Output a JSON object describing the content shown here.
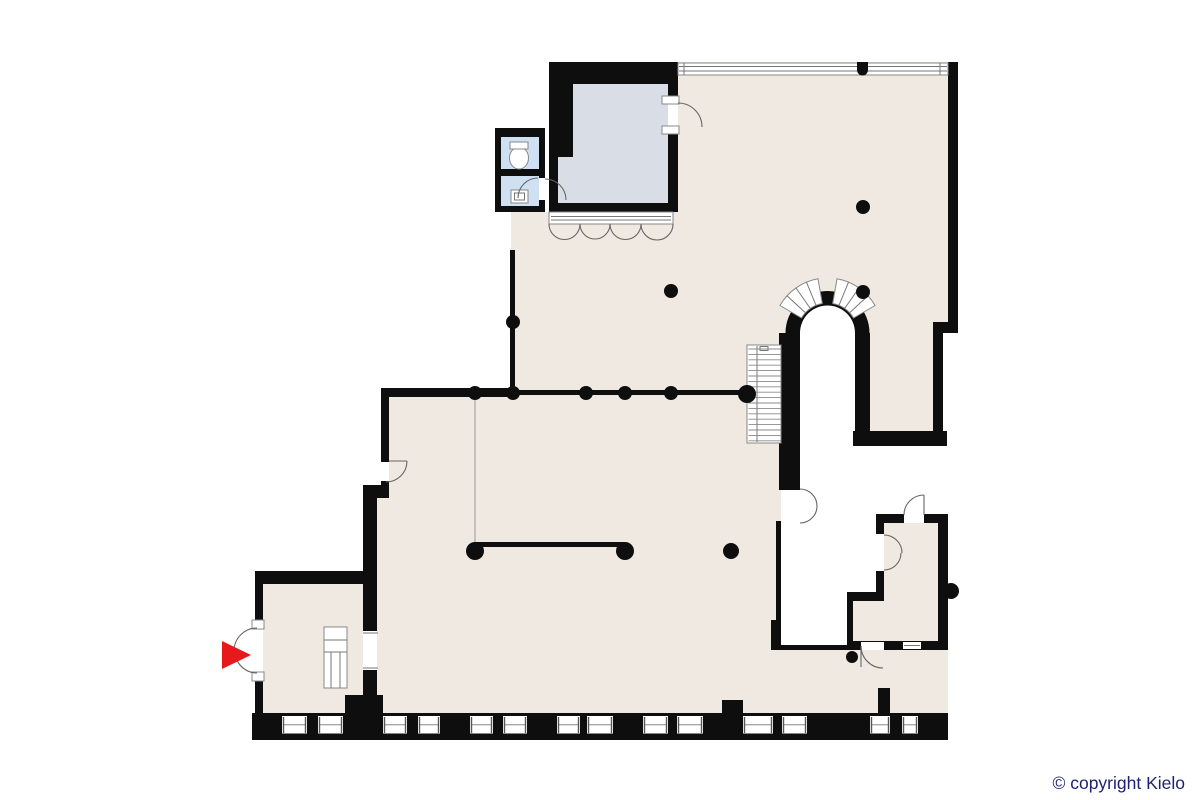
{
  "title": "building-floor-plan",
  "canvas": {
    "width": 1200,
    "height": 800
  },
  "footer": {
    "copyright": "© copyright Kielo"
  },
  "colors": {
    "background": "#ffffff",
    "wall": "#0e0e0e",
    "floor": "#f0e9e1",
    "annex_room": "#d9dde5",
    "bathroom": "#cfe0f2",
    "entrance_arrow": "#e8191c",
    "copyright_text": "#1f2270",
    "detail_line": "#8f8f8f"
  },
  "features": {
    "entrance_marker": "red-arrow",
    "column_dot_count": 14,
    "bottom_window_segment_count": 14,
    "storefront_folding_door_leaves": 4,
    "has_staircase": true,
    "has_arched_opening_with_fanlight": true,
    "bathroom_fixtures": [
      "toilet",
      "sink"
    ]
  }
}
